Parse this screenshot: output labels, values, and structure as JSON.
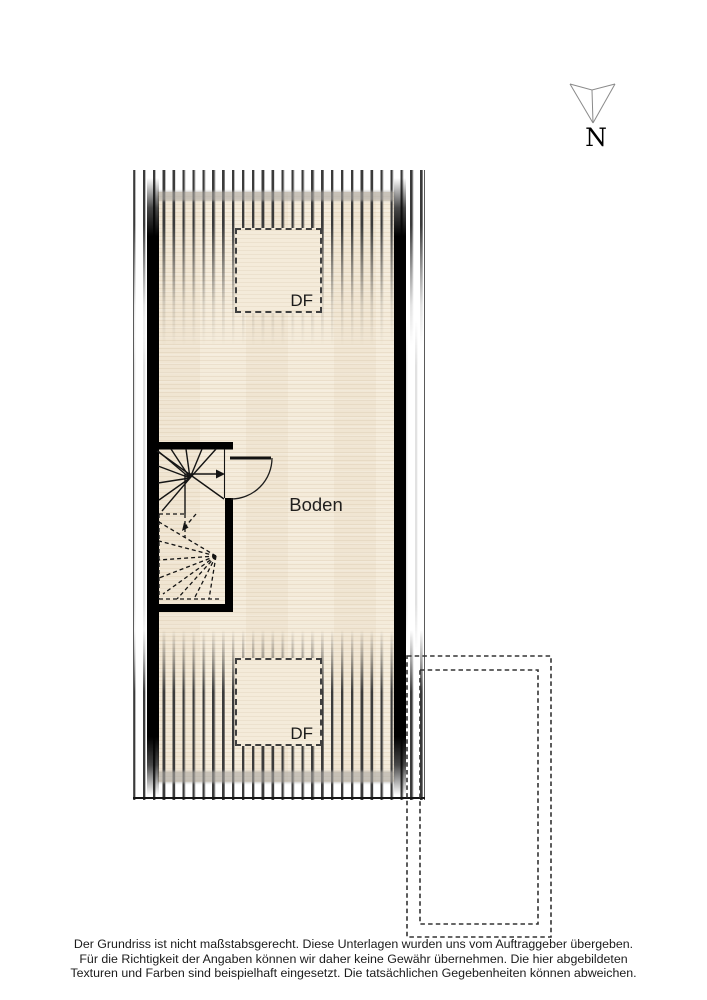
{
  "colors": {
    "floor": "#f4ebda",
    "hatch": "#3b3b3b",
    "wall": "#000000",
    "line": "#141414",
    "dash": "#3f3f3f",
    "text": "#1b1b1b",
    "compass": "#8a8a8a"
  },
  "compass": {
    "label": "N"
  },
  "plan": {
    "room": {
      "label": "Boden"
    },
    "roof_windows": {
      "top_label": "DF",
      "bottom_label": "DF"
    }
  },
  "disclaimer": {
    "lines": [
      "Der Grundriss ist nicht maßstabsgerecht. Diese Unterlagen wurden uns vom Auftraggeber übergeben.",
      "Für die Richtigkeit der Angaben können wir daher keine Gewähr übernehmen. Die hier abgebildeten",
      "Texturen und Farben sind beispielhaft eingesetzt. Die tatsächlichen Gegebenheiten können abweichen."
    ]
  }
}
